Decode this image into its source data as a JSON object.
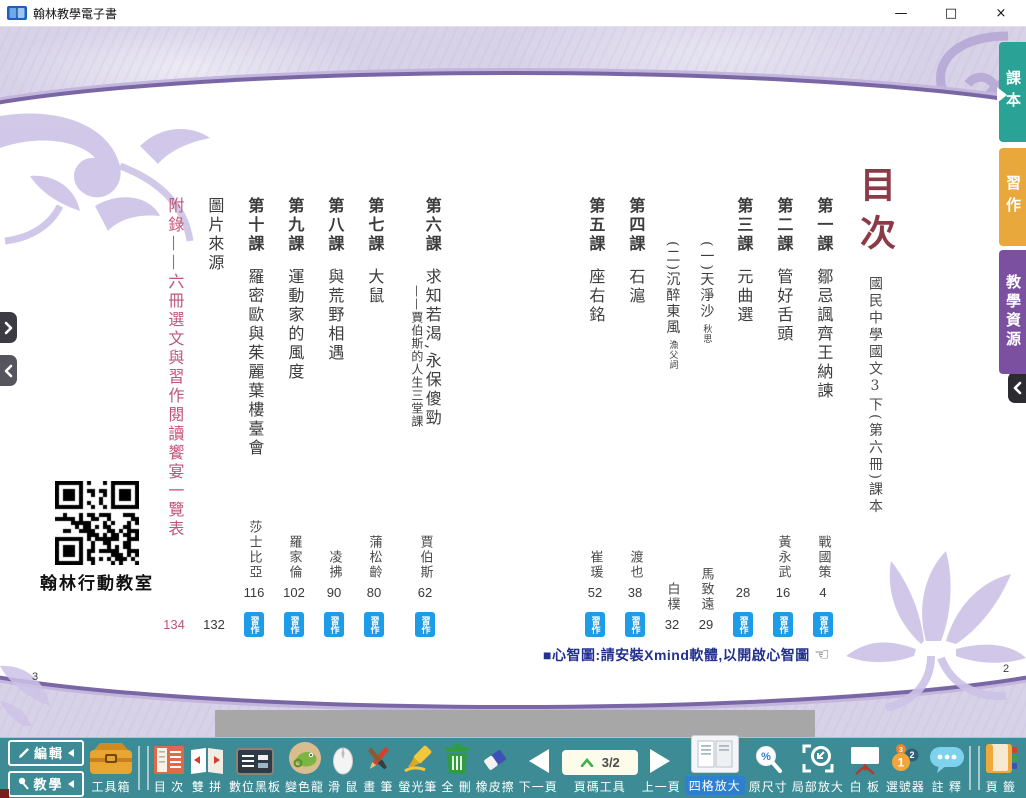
{
  "titlebar": {
    "title": "翰林教學電子書",
    "minimize": "—",
    "maximize": "□",
    "close": "×"
  },
  "side_tabs": [
    {
      "id": "textbook",
      "label": "課本",
      "color": "#2aa295",
      "active": true
    },
    {
      "id": "workbook",
      "label": "習作",
      "color": "#e9a83c",
      "active": false
    },
    {
      "id": "resources",
      "label": "教學資源",
      "color": "#7b50a0",
      "active": false
    }
  ],
  "toc": {
    "title": "目次",
    "subtitle": "國民中學國文3下(第六冊)課本",
    "right_page_entries": [
      {
        "label": "第一課",
        "title": "鄒忌諷齊王納諫",
        "author": "戰國策",
        "page": "4",
        "workbook_badge": true
      },
      {
        "label": "第二課",
        "title": "管好舌頭",
        "author": "黃永武",
        "page": "16",
        "workbook_badge": true
      },
      {
        "label": "第三課",
        "title": "元曲選",
        "author": "",
        "page": "28",
        "workbook_badge": true
      },
      {
        "title": "(一)天淨沙",
        "annotation": "秋思",
        "author": "馬致遠",
        "page": "29",
        "sub": true
      },
      {
        "title": "(二)沉醉東風",
        "annotation": "漁父詞",
        "author": "白樸",
        "page": "32",
        "sub": true
      },
      {
        "label": "第四課",
        "title": "石滬",
        "author": "渡也",
        "page": "38",
        "workbook_badge": true
      },
      {
        "label": "第五課",
        "title": "座右銘",
        "author": "崔瑗",
        "page": "52",
        "workbook_badge": true
      }
    ],
    "left_page_entries": [
      {
        "label": "第六課",
        "title": "求知若渴,永保傻勁",
        "subtitle": "——賈伯斯的人生三堂課",
        "author": "賈伯斯",
        "page": "62",
        "workbook_badge": true,
        "wide": true
      },
      {
        "label": "第七課",
        "title": "大鼠",
        "author": "蒲松齡",
        "page": "80",
        "workbook_badge": true
      },
      {
        "label": "第八課",
        "title": "與荒野相遇",
        "author": "凌拂",
        "page": "90",
        "workbook_badge": true
      },
      {
        "label": "第九課",
        "title": "運動家的風度",
        "author": "羅家倫",
        "page": "102",
        "workbook_badge": true
      },
      {
        "label": "第十課",
        "title": "羅密歐與茱麗葉樓臺會",
        "author": "莎士比亞",
        "page": "116",
        "workbook_badge": true
      },
      {
        "title": "圖片來源",
        "page": "132"
      },
      {
        "title": "附錄——六冊選文與習作閱讀饗宴一覽表",
        "page": "134",
        "accent": true
      }
    ],
    "badge_label": "習作",
    "badge_color": "#1f9ce8",
    "accent_color": "#c25576",
    "note": "■心智圖:請安裝Xmind軟體,以開啟心智圖",
    "note_icon": "pointing-hand",
    "qr_caption": "翰林行動教室",
    "page_number_left": "3",
    "page_number_right": "2"
  },
  "toolbar": {
    "edit": "編輯",
    "teach": "教學",
    "toolbox": "工具箱",
    "items": {
      "toc": "目 次",
      "twin": "雙 拼",
      "blackboard": "數位黑板",
      "chameleon": "變色龍",
      "mouse": "滑 鼠",
      "brush": "畫 筆",
      "highlighter": "螢光筆",
      "delete_all": "全 刪",
      "eraser": "橡皮擦",
      "next_page": "下一頁",
      "page_tool": "頁碼工具",
      "prev_page": "上一頁",
      "quad_zoom": "四格放大",
      "original_size": "原尺寸",
      "partial_zoom": "局部放大",
      "whiteboard": "白 板",
      "number_picker": "選號器",
      "annotation": "註 釋",
      "page_tab": "頁 籤"
    },
    "page_indicator": "3/2",
    "selected_tool": "四格放大"
  }
}
